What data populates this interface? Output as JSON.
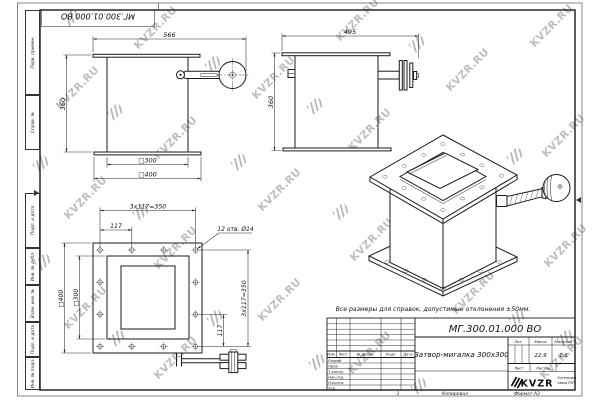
{
  "sheet": {
    "watermark_text": "KVZR.RU",
    "note": "Все размеры для справок, допустимые отклонения ±50мм.",
    "top_stamp": "МГ.300.01.000 ВО",
    "margin_fields": [
      "Перв. примен.",
      "Справ. №",
      "Подп. и дата",
      "Инв. № дубл.",
      "Взам. инв. №",
      "Подп. и дата",
      "Инв. № подл."
    ],
    "footer": {
      "sheet_no": "1",
      "copied": "Копировал",
      "format": "Формат А3"
    }
  },
  "views": {
    "front": {
      "dim_width": "566",
      "dim_height": "360",
      "dim_duct": "□300",
      "dim_flange": "□400"
    },
    "side": {
      "dim_width": "495",
      "dim_height": "360"
    },
    "plan": {
      "dim_bolt_pitch_total_top": "3x117=350",
      "dim_bolt_pitch_top": "117",
      "holes_note": "12 отв. Ø14",
      "dim_flange": "□400",
      "dim_duct": "□300",
      "dim_bolt_pitch_total_right": "3x117=350",
      "dim_bolt_pitch_right": "117"
    }
  },
  "title_block": {
    "designation": "МГ.300.01.000 ВО",
    "name": "Затвор-мигалка 300x300",
    "col_headers": [
      "Изм.",
      "Лист",
      "№ докум.",
      "Подп.",
      "Дата"
    ],
    "row_labels": [
      "Разраб.",
      "Пров.",
      "Т.контр.",
      "Нач.отд.",
      "Н.контр.",
      "Утв."
    ],
    "lit_header": "Лит.",
    "mass_header": "Масса",
    "scale_header": "Масштаб",
    "mass": "22,9",
    "scale": "1:6",
    "sheet_label": "Лист",
    "sheets_label": "Листов",
    "logo_text": "KVZR",
    "logo_caption1": "Котельный",
    "logo_caption2": "завод РЭП"
  }
}
